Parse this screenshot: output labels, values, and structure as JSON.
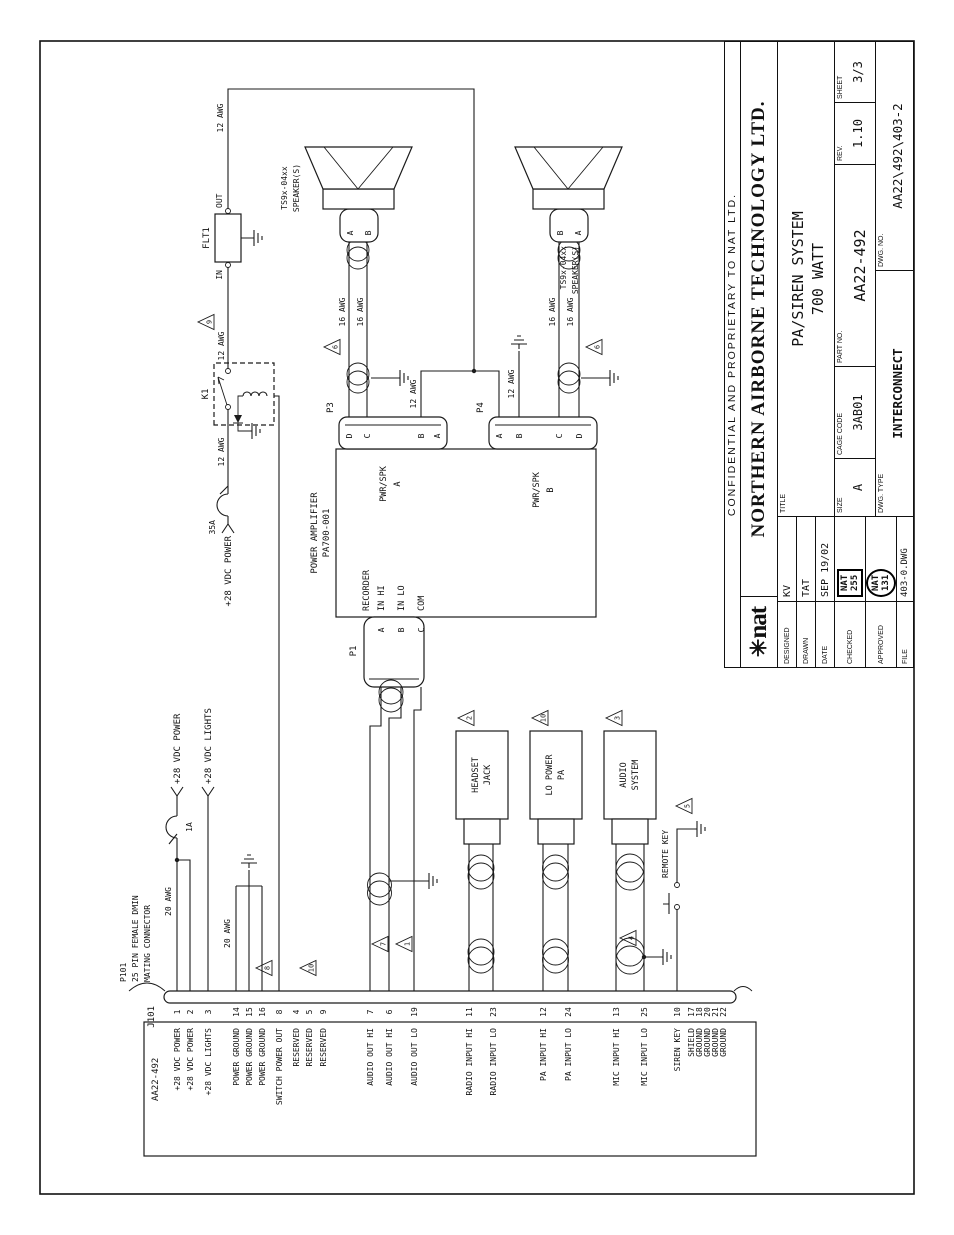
{
  "sheet": {
    "confidential": "CONFIDENTIAL AND PROPRIETARY TO NAT LTD.",
    "logo_star": "✳",
    "logo_text": "nat",
    "company": "NORTHERN AIRBORNE TECHNOLOGY LTD.",
    "designed_label": "DESIGNED",
    "designed": "KV",
    "drawn_label": "DRAWN",
    "drawn": "TAT",
    "date_label": "DATE",
    "date": "SEP 19/02",
    "checked_label": "CHECKED",
    "checked_stamp_line1": "NAT",
    "checked_stamp_line2": "255",
    "approved_label": "APPROVED",
    "approved_stamp_line1": "NAT",
    "approved_stamp_line2": "131",
    "file_label": "FILE",
    "file": "403-0.DWG",
    "title_label": "TITLE",
    "title_line1": "PA/SIREN SYSTEM",
    "title_line2": "700 WATT",
    "size_label": "SIZE",
    "size": "A",
    "cage_label": "CAGE CODE",
    "cage": "3AB01",
    "part_label": "PART NO.",
    "part": "AA22-492",
    "rev_label": "REV.",
    "rev": "1.10",
    "sheet_label": "SHEET",
    "sheet": "3/3",
    "dwg_type_label": "DWG. TYPE",
    "dwg_type": "INTERCONNECT",
    "dwg_no_label": "DWG. NO.",
    "dwg_no": "AA22\\492\\403-2"
  },
  "connector": {
    "cable": "AA22-492",
    "name": "J101",
    "mating_line1": "P101",
    "mating_line2": "25 PIN FEMALE DMIN",
    "mating_line3": "MATING CONNECTOR",
    "pins": [
      {
        "n": "1",
        "label": "+28 VDC POWER"
      },
      {
        "n": "2",
        "label": "+28 VDC POWER"
      },
      {
        "n": "3",
        "label": "+28 VDC LIGHTS"
      },
      {
        "n": "14",
        "label": "POWER GROUND"
      },
      {
        "n": "15",
        "label": "POWER GROUND"
      },
      {
        "n": "16",
        "label": "POWER GROUND"
      },
      {
        "n": "8",
        "label": "SWITCH POWER OUT"
      },
      {
        "n": "4",
        "label": "RESERVED"
      },
      {
        "n": "5",
        "label": "RESERVED"
      },
      {
        "n": "9",
        "label": "RESERVED"
      },
      {
        "n": "7",
        "label": "AUDIO OUT HI"
      },
      {
        "n": "6",
        "label": "AUDIO OUT HI"
      },
      {
        "n": "19",
        "label": "AUDIO OUT LO"
      },
      {
        "n": "11",
        "label": "RADIO INPUT HI"
      },
      {
        "n": "23",
        "label": "RADIO INPUT LO"
      },
      {
        "n": "12",
        "label": "PA INPUT HI"
      },
      {
        "n": "24",
        "label": "PA INPUT LO"
      },
      {
        "n": "13",
        "label": "MIC INPUT HI"
      },
      {
        "n": "25",
        "label": "MIC INPUT LO"
      },
      {
        "n": "10",
        "label": "SIREN KEY"
      },
      {
        "n": "17",
        "label": "SHIELD"
      },
      {
        "n": "18",
        "label": "GROUND"
      },
      {
        "n": "20",
        "label": "GROUND"
      },
      {
        "n": "21",
        "label": "GROUND"
      },
      {
        "n": "22",
        "label": "GROUND"
      }
    ]
  },
  "amp": {
    "line1": "POWER AMPLIFIER",
    "line2": "PA700-001",
    "p1": "P1",
    "p3": "P3",
    "p4": "P4",
    "recorder": "RECORDER",
    "in_hi": "IN HI",
    "in_lo": "IN LO",
    "com": "COM",
    "pwr_spk": "PWR/SPK",
    "sec_a": "A",
    "sec_b": "B",
    "p1_pins": [
      "A",
      "B",
      "C"
    ],
    "p3_pins": [
      "D",
      "C",
      "B",
      "A"
    ],
    "p4_pins": [
      "A",
      "B",
      "C",
      "D"
    ]
  },
  "speaker": {
    "model": "TS9x-04xx",
    "name": "SPEAKER(S)",
    "t_a": "A",
    "t_b": "B"
  },
  "labels": {
    "flt1": "FLT1",
    "in": "IN",
    "out": "OUT",
    "k1": "K1",
    "a35": "35A",
    "a1": "1A",
    "v28_power": "+28 VDC POWER",
    "v28_lights": "+28 VDC LIGHTS",
    "awg12": "12 AWG",
    "awg16": "16 AWG",
    "awg20": "20 AWG",
    "headset1": "HEADSET",
    "headset2": "JACK",
    "lopa1": "LO POWER",
    "lopa2": "PA",
    "audio1": "AUDIO",
    "audio2": "SYSTEM",
    "remote_key": "REMOTE KEY"
  },
  "notes": {
    "1": "1",
    "2": "2",
    "3": "3",
    "4": "4",
    "5": "5",
    "6": "6",
    "7": "7",
    "8": "8",
    "9": "9",
    "10": "10"
  }
}
